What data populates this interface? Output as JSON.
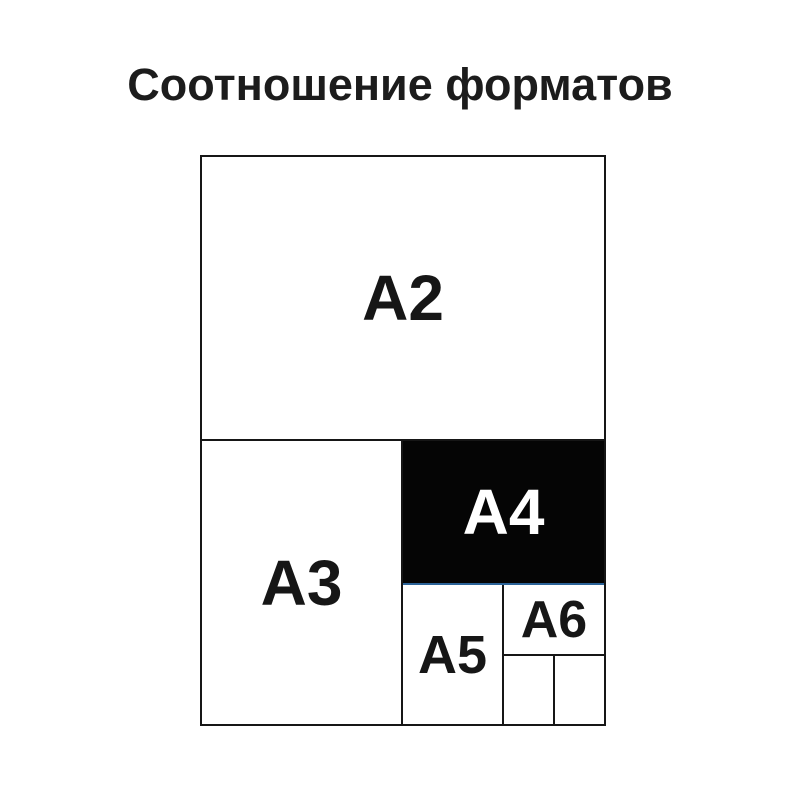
{
  "title": "Соотношение форматов",
  "diagram": {
    "formats": {
      "a2": {
        "label": "A2"
      },
      "a3": {
        "label": "A3"
      },
      "a4": {
        "label": "A4"
      },
      "a5": {
        "label": "A5"
      },
      "a6": {
        "label": "A6"
      }
    },
    "colors": {
      "background": "#ffffff",
      "outline": "#161616",
      "a4_fill": "#000000",
      "a4_text": "#ffffff",
      "a4_underline_blue": "#2b6398"
    }
  }
}
